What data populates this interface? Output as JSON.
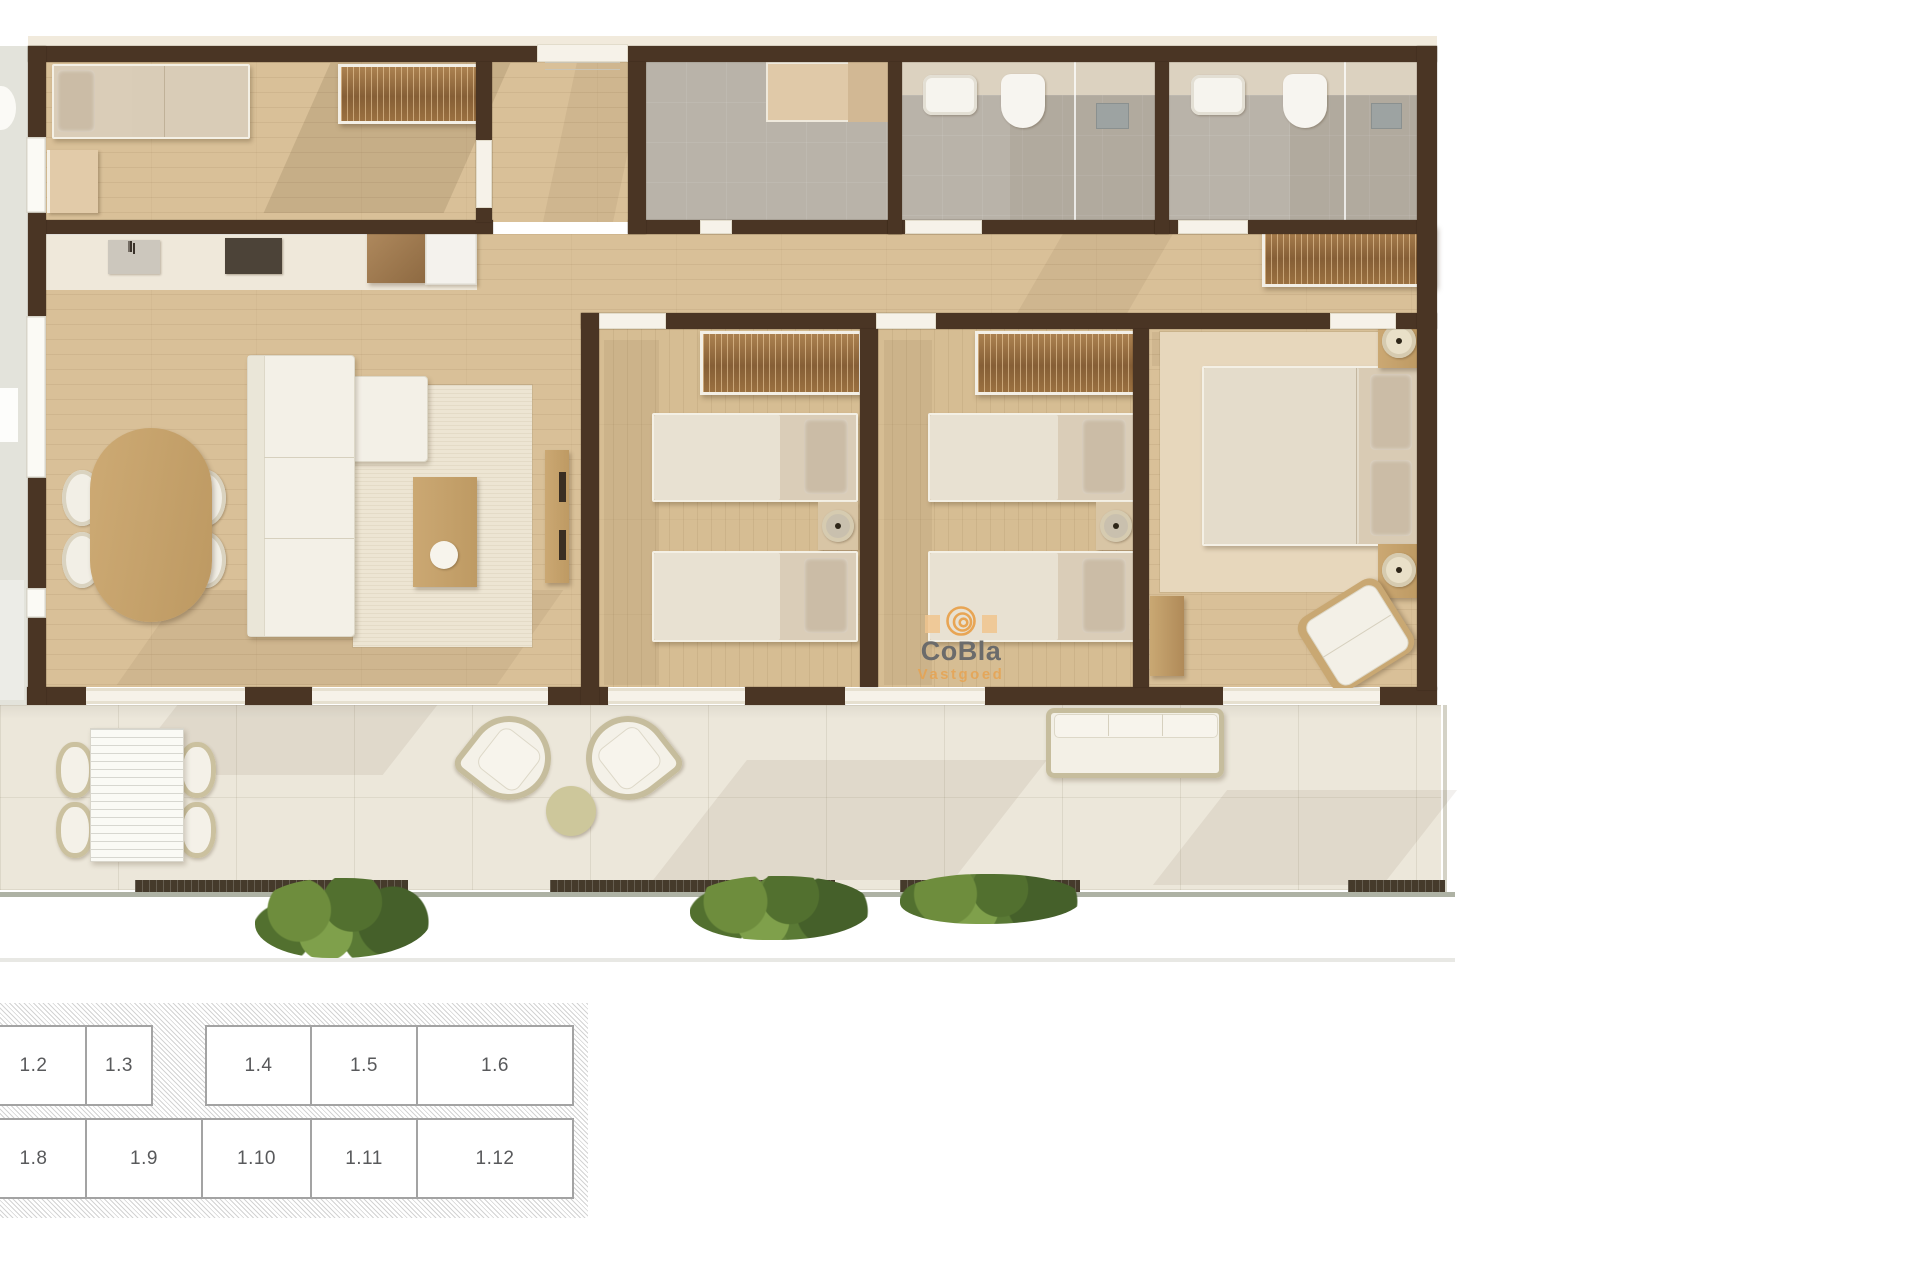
{
  "watermark": {
    "brand": "CoBla",
    "subtitle": "Vastgoed"
  },
  "site_grid": {
    "row1": [
      {
        "label": "1.2"
      },
      {
        "label": "1.3"
      },
      {
        "label": "1.4"
      },
      {
        "label": "1.5"
      },
      {
        "label": "1.6"
      }
    ],
    "row2": [
      {
        "label": "1.8"
      },
      {
        "label": "1.9"
      },
      {
        "label": "1.10"
      },
      {
        "label": "1.11"
      },
      {
        "label": "1.12"
      }
    ]
  },
  "palette": {
    "wall": "#4A3524",
    "wood_floor": "#D9C098",
    "terrace_floor": "#ECE7DA",
    "bathroom_floor": "#B9B3A9",
    "accent_orange": "#E8A24E",
    "watermark_gray": "#6B6B6B",
    "grid_border": "#A3A3A3",
    "grid_text": "#58595B",
    "plant_green": "#62813A"
  }
}
